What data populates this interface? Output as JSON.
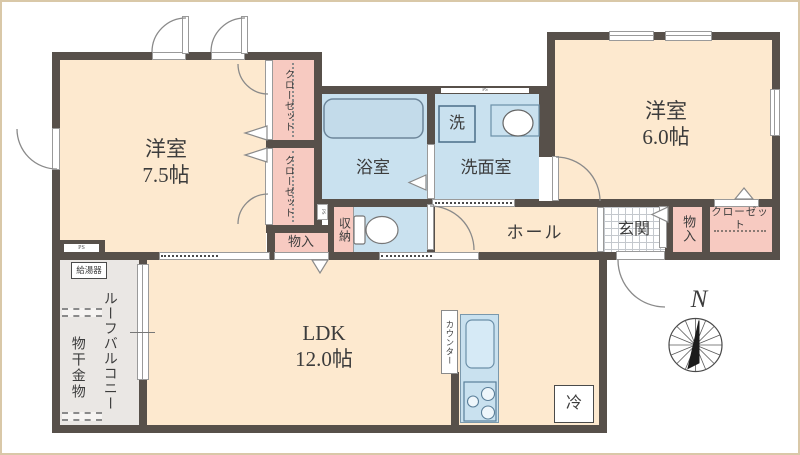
{
  "plan_title": "apartment-floor-plan",
  "labels": {
    "room75_name": "洋室",
    "room75_size": "7.5帖",
    "room60_name": "洋室",
    "room60_size": "6.0帖",
    "ldk_name": "LDK",
    "ldk_size": "12.0帖",
    "bathroom": "浴室",
    "washroom": "洗面室",
    "washer": "洗",
    "hall": "ホール",
    "entrance": "玄関",
    "storage_mid": "物入",
    "storage_right": "物入",
    "shuno": "収納",
    "closet_upper": "クローゼット",
    "closet_lower": "クローゼット",
    "closet_right": "クローゼット",
    "balcony": "ルーフバルコニー",
    "laundry_hardware": "物干金物",
    "water_heater": "給湯器",
    "counter": "カウンター",
    "fridge": "冷",
    "north": "N",
    "ps1": "PS",
    "ps2": "PS",
    "ps3": "PS"
  },
  "colors": {
    "wall": "#57504a",
    "room_floor": "#fde9cf",
    "wet_area": "#c9e1ef",
    "closet_pink": "#f7cac1",
    "balcony_gray": "#eae7e4",
    "bathtub": "#c3dbea",
    "frame_border": "#d9c8a8"
  }
}
